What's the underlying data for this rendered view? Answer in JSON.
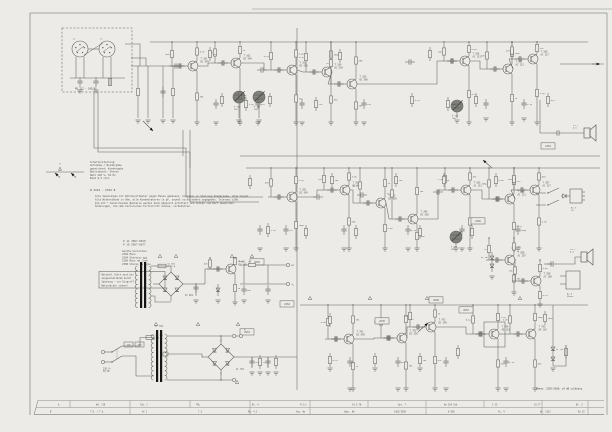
{
  "colors": {
    "paper": "#ecebe7",
    "ink": "#63635e",
    "text": "#4a4a44",
    "light": "#8d8d88",
    "dark": "#161616",
    "shade": "#6e6e68",
    "fold": "#b5b4ae"
  },
  "labels": {
    "headbox": "PU 212 - 242/US",
    "sp_l": "li",
    "sp_r": "re",
    "legend_a": "a",
    "t101": "T 101|BC 549",
    "t102": "T 102|BC 549",
    "t103": "T 103|BC 550",
    "t104": "T 104|BC 550",
    "t105": "T 105|BC 560",
    "t106": "T 106|AC 151",
    "t107": "T 107|AC 151",
    "t108": "T 108|AC 117",
    "t201": "T 201|BC 549",
    "t202": "T 202|BC 549",
    "t203": "T 203|BC 550",
    "t204": "T 204|BC 550",
    "t205": "T 205|AC 151",
    "t206": "T 206|AC 151",
    "t207": "T 207|AC 117",
    "t208": "T 208|AC 187",
    "t209": "T 209|AC 188",
    "t301": "T 701|BC 548",
    "t302": "T 702|BC 558",
    "t303": "T 703|BC 140",
    "t304": "T 704|AD 161",
    "t305": "T 705|AD 162",
    "t601": "T 601|BC 140",
    "p101": "P 101|25k",
    "p102": "P 102|25k",
    "p103": "P 103|10k",
    "p201": "P 201|25k",
    "si601": "Si 601|0,16 A",
    "si701": "Si 701|0,8 A",
    "gl601": "Gl 601",
    "gl701": "Gl 701",
    "tr601": "Tr 601",
    "tr701": "Tr 701",
    "sel110": "110",
    "sel220": "220",
    "netz": "220 V~|50 Hz",
    "bu3": "Bu 3|LS",
    "bu4": "Bu 4|Phone",
    "ls1": "LS 1|4 Ω",
    "ls2": "LS 2|4 Ω",
    "a_term": "A",
    "plusC": "+C",
    "minusL": "−L",
    "di1": "Di 705",
    "di2": "Di 201"
  },
  "values": [
    "4,7k",
    "10k",
    "100k",
    "1k",
    "47k",
    "220",
    "2,2µ",
    "22n",
    "0,1µ",
    "100µ",
    "470",
    "3,3k",
    "560",
    "15k",
    "1n",
    "6,8k"
  ],
  "boxes": [
    "2650",
    "2262",
    "2630",
    "2266",
    "2600",
    "2610",
    "2264",
    "2652"
  ],
  "notes": {
    "w_code": "W 2312 - 2332 B",
    "legend": [
      "Schalterstellung:",
      "Aufnahme / Wiedergabe",
      "gezeichnet: Wiedergabe",
      "Betriebsart: Stereo",
      "Netz 220 V~  50 Hz",
      "Band 9,5 cm/s"
    ],
    "para": [
      "Alle Spannungen mit Röhrenvoltmeter gegen Masse gemessen, Schalter in Stellung Wiedergabe, ohne Signal.",
      "Alle Widerstände in Ohm, alle Kondensatoren in pF, soweit nicht anders angegeben. Toleranz ±10%.",
      "Die mit * bezeichneten Bauteile werden beim Abgleich ermittelt und können vom Wert abweichen.",
      "Änderungen, die dem technischen Fortschritt dienen, vorbehalten."
    ],
    "pcodes": [
      "P 11   2967-0019",
      "P 10   2967-0077"
    ],
    "variants": [
      "Geräte-Varianten:",
      "2302  Mono",
      "2304  Stereo",
      "2306  Mono  de luxe",
      "2308  Stereo de luxe"
    ],
    "boxed": [
      "Netzteil führt auch bei",
      "ausgeschaltetem Gerät",
      "Spannung — vor Eingriff",
      "Netzstecker ziehen!"
    ],
    "measure": "Messw. 2302–2308: ±4 dB zulässig"
  },
  "table": {
    "row1": [
      "6",
      "Wd. 719",
      "Tgl. C",
      "TRL",
      "Bl. 4",
      "M 1:1",
      "14.3.78",
      "Gpr. 7",
      "Wz 104 Stk",
      "S 12",
      "10.77",
      "Bl. 2"
    ],
    "row2": [
      "B",
      "T.O. / T.G.",
      "AC 1",
      "7.2",
      "Rd. 4.1",
      "Gez. Ws",
      "Gepr. Hb",
      "2302/2308",
      "K 605",
      "St. 4",
      "Nr. 2312",
      "Ra 22"
    ]
  }
}
